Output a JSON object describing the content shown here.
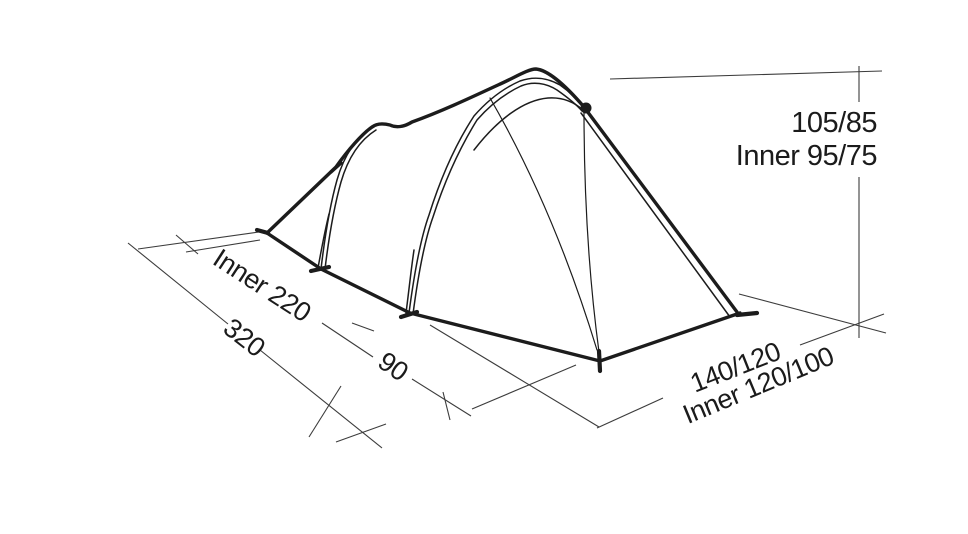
{
  "diagram": {
    "type": "tent-dimension-diagram",
    "description": "Technical line drawing of a tunnel tent with external dimension lines",
    "labels": {
      "height_total": "105/85",
      "height_inner": "Inner 95/75",
      "length_inner": "Inner 220",
      "length_total": "320",
      "vestibule_depth": "90",
      "width_total": "140/120",
      "width_inner": "Inner 120/100"
    },
    "dimensions": {
      "total_length_cm": 320,
      "inner_length_cm": 220,
      "vestibule_depth_cm": 90,
      "height_front_rear_cm": "105/85",
      "inner_height_front_rear_cm": "95/75",
      "width_front_rear_cm": "140/120",
      "inner_width_front_rear_cm": "120/100"
    },
    "colors": {
      "background": "#ffffff",
      "tent_line": "#1c1c1c",
      "dimension_line": "#3c3c3c",
      "text": "#1b1b1b"
    }
  }
}
